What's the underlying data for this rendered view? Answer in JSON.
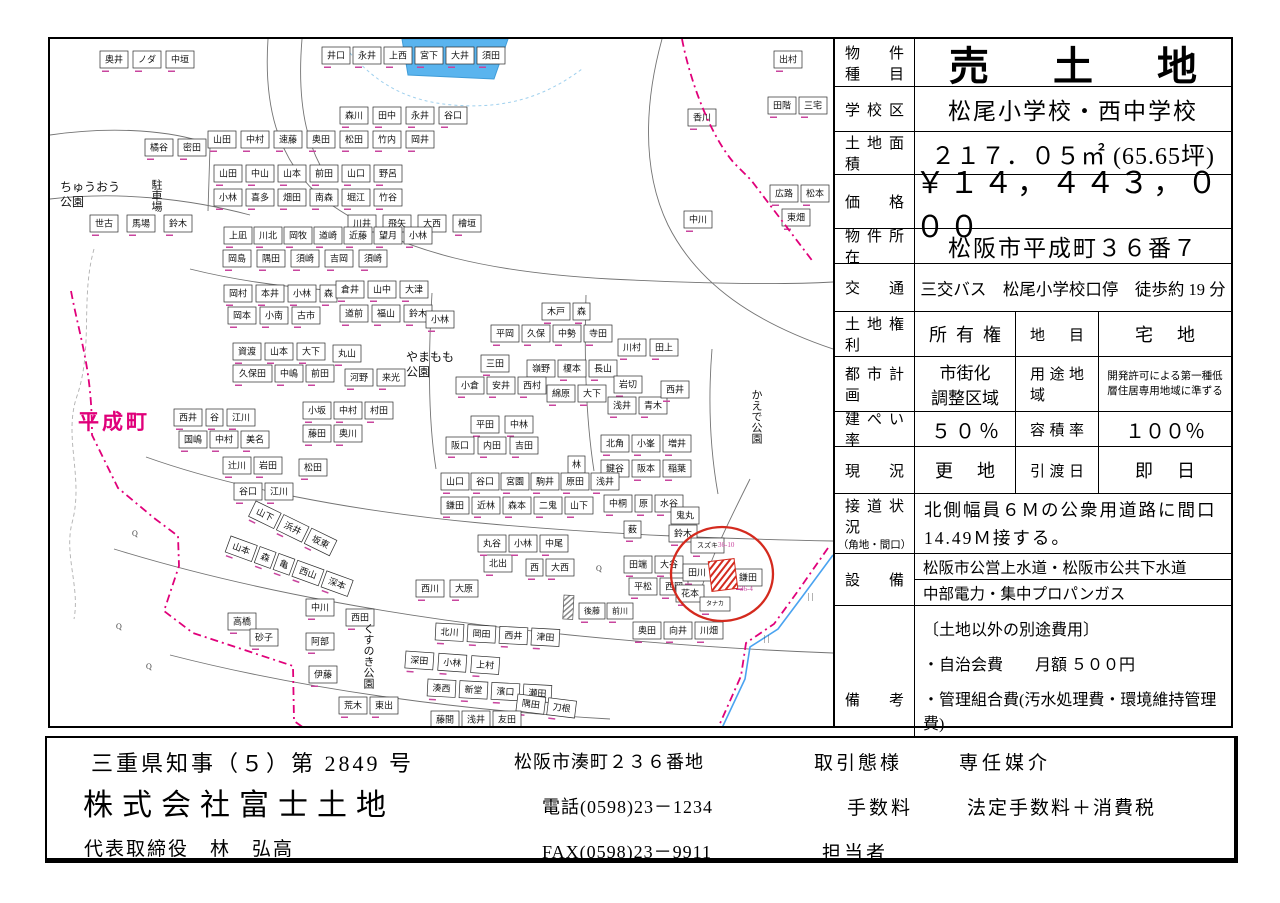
{
  "table": {
    "rows": {
      "property_type": {
        "label": "物件\n種目",
        "value": "売土地"
      },
      "school": {
        "label": "学校区",
        "value": "松尾小学校・西中学校"
      },
      "land_area": {
        "label": "土地面積",
        "value": "２１７．０５㎡ (65.65坪)"
      },
      "price": {
        "label": "価格",
        "value": "￥１４，４４３，０００"
      },
      "location": {
        "label": "物件所在",
        "value": "松阪市平成町３６番７"
      },
      "transport": {
        "label": "交通",
        "value": "三交バス　松尾小学校口停　徒歩約 19 分"
      },
      "land_rights": {
        "label": "土地権利",
        "value": "所有権",
        "label2": "地目",
        "value2": "宅地"
      },
      "city_planning": {
        "label": "都市計画",
        "value": "市街化\n調整区域",
        "label2": "用途地域",
        "value2": "開発許可による第一種低層住居専用地域に準ずる"
      },
      "coverage": {
        "label": "建ぺい率",
        "value": "５０％",
        "label2": "容積率",
        "value2": "１００％"
      },
      "status": {
        "label": "現況",
        "value": "更地",
        "label2": "引渡日",
        "value2": "即日"
      },
      "road": {
        "label": "接道状況",
        "sublabel": "（角地・間口）",
        "value": "北側幅員６Ｍの公衆用道路に間口 14.49Ｍ接する。"
      },
      "utilities": {
        "label": "設備",
        "line1": "松阪市公営上水道・松阪市公共下水道",
        "line2": "中部電力・集中プロパンガス"
      },
      "remarks": {
        "label": "備考",
        "heading": "〔土地以外の別途費用〕",
        "items": [
          "・自治会費　　月額 ５００円",
          "・管理組合費(汚水処理費・環境維持管理費)"
        ],
        "amount": "月額 ３，２００円"
      }
    }
  },
  "footer": {
    "license": "三重県知事（５）第 2849 号",
    "company": "株式会社富士土地",
    "representative": "代表取締役　林　弘高",
    "address": "松阪市湊町２３６番地",
    "phone": "電話(0598)23－1234",
    "fax": "FAX(0598)23－9911",
    "deal_type_label": "取引態様",
    "deal_type": "専任媒介",
    "fee_label": "手数料",
    "fee": "法定手数料＋消費税",
    "agent_label": "担当者"
  },
  "map": {
    "colors": {
      "boundary": "#e0007a",
      "water": "#5ab4ee",
      "stream": "#4aa3f0",
      "marker": "#d42a1e",
      "lot_number": "#c8459e"
    },
    "pond": {
      "points": "352,0 458,0 444,40 358,36",
      "outline": "M300,14 C330,48 360,62 402,66 C452,70 492,60 532,30"
    },
    "roads": [
      "M218,0 C214,60 224,122 276,162 C350,216 450,234 560,240 C660,245 730,246 783,243",
      "M252,0 C248,48 252,92 270,126",
      "M0,96 C55,88 110,90 150,102",
      "M0,160 C70,152 140,160 200,176",
      "M612,0 C596,58 590,128 618,186 C648,246 706,284 783,310",
      "M140,230 C180,240 230,248 290,252",
      "M96,418 C180,448 300,472 430,484 C560,496 680,500 783,502",
      "M64,510 C200,552 360,580 520,596 C640,608 730,612 783,614",
      "M120,616 C260,652 420,672 560,680",
      "M382,254 C378,320 378,380 386,430",
      "M536,256 C534,320 536,380 544,432",
      "M662,310 C658,360 660,410 668,455",
      "M160,108 L158,172",
      "M700,440 C680,480 660,520 648,560"
    ],
    "contour": "M44,210 C30,260 44,310 26,360 C14,400 34,440 22,484 C14,516 30,548 24,580",
    "boundaries": [
      "M632,0 C640,42 660,96 684,124 L701,141 L764,224",
      "M21,252 C30,300 42,330 42,396 L68,449 L104,479 L128,497 L129,527 L114,572 L143,594 L243,627 L244,682 L254,689",
      "M778,509 L748,552 L724,585 L696,604 L691,637 L668,689"
    ],
    "stream": "M783,516 L752,558 L728,590 L700,608 L695,640 L672,689",
    "labels": [
      {
        "name": "label-heiseicho",
        "text": "平成町",
        "x": 28,
        "y": 390,
        "size": 21,
        "magenta": true,
        "bold": true,
        "spacing": 3
      },
      {
        "name": "label-chuo-park",
        "text": "ちゅうおう\n公園",
        "x": 10,
        "y": 152,
        "size": 12
      },
      {
        "name": "label-yamamomo-park",
        "text": "やまもも\n公園",
        "x": 356,
        "y": 322,
        "size": 12
      },
      {
        "name": "label-kaede-park",
        "text": "かえで公園",
        "x": 706,
        "y": 350,
        "size": 11,
        "vertical": true
      },
      {
        "name": "label-kusunoki-park",
        "text": "くすのき公園",
        "x": 318,
        "y": 584,
        "size": 11,
        "vertical": true
      },
      {
        "name": "label-parking",
        "text": "駐車場",
        "x": 106,
        "y": 140,
        "size": 11,
        "vertical": true
      }
    ],
    "symbols": [
      {
        "t": "Q",
        "x": 82,
        "y": 497
      },
      {
        "t": "Q",
        "x": 66,
        "y": 590
      },
      {
        "t": "Q",
        "x": 96,
        "y": 630
      },
      {
        "t": "Q",
        "x": 546,
        "y": 532
      },
      {
        "t": "| |",
        "x": 758,
        "y": 560
      },
      {
        "t": "| |",
        "x": 714,
        "y": 602
      }
    ],
    "parcel_rows": [
      {
        "x": 50,
        "y": 12,
        "names": [
          "奥井",
          "ノダ",
          "中垣"
        ]
      },
      {
        "x": 95,
        "y": 100,
        "names": [
          "橘谷",
          "密田"
        ]
      },
      {
        "x": 40,
        "y": 176,
        "gap": 9,
        "names": [
          "世古",
          "馬場",
          "鈴木"
        ]
      },
      {
        "x": 272,
        "y": 8,
        "gap": 3,
        "names": [
          "井口",
          "永井",
          "上西",
          "宮下",
          "大井",
          "須田"
        ]
      },
      {
        "x": 290,
        "y": 68,
        "gap": 5,
        "names": [
          "森川",
          "田中",
          "永井",
          "谷口"
        ]
      },
      {
        "x": 638,
        "y": 70,
        "names": [
          "香川"
        ]
      },
      {
        "x": 298,
        "y": 176,
        "gap": 7,
        "names": [
          "川井",
          "飛矢",
          "大西",
          "檜垣"
        ]
      },
      {
        "x": 634,
        "y": 172,
        "names": [
          "中川"
        ]
      },
      {
        "x": 724,
        "y": 12,
        "names": [
          "出村"
        ]
      },
      {
        "x": 718,
        "y": 58,
        "gap": 3,
        "names": [
          "田階",
          "三宅"
        ]
      },
      {
        "x": 720,
        "y": 146,
        "gap": 3,
        "names": [
          "広路",
          "松本"
        ]
      },
      {
        "x": 732,
        "y": 170,
        "names": [
          "東畑"
        ]
      },
      {
        "x": 158,
        "y": 92,
        "gap": 5,
        "names": [
          "山田",
          "中村",
          "速藤",
          "奥田",
          "松田",
          "竹内",
          "岡井"
        ]
      },
      {
        "x": 164,
        "y": 126,
        "gap": 4,
        "names": [
          "山田",
          "中山",
          "山本",
          "前田",
          "山口",
          "野呂"
        ]
      },
      {
        "x": 164,
        "y": 150,
        "gap": 4,
        "names": [
          "小林",
          "喜多",
          "畑田",
          "南森",
          "堀江",
          "竹谷"
        ]
      },
      {
        "x": 174,
        "y": 188,
        "gap": 2,
        "names": [
          "上凪",
          "川北",
          "岡牧",
          "道崎",
          "近藤",
          "望月",
          "小林"
        ]
      },
      {
        "x": 173,
        "y": 211,
        "gap": 6,
        "names": [
          "岡島",
          "隅田",
          "須崎",
          "吉岡",
          "須崎"
        ]
      },
      {
        "x": 174,
        "y": 246,
        "gap": 4,
        "names": [
          "岡村",
          "本井",
          "小林",
          "森"
        ]
      },
      {
        "x": 286,
        "y": 242,
        "gap": 4,
        "names": [
          "倉井",
          "山中",
          "大津"
        ]
      },
      {
        "x": 178,
        "y": 268,
        "gap": 4,
        "names": [
          "岡本",
          "小南",
          "古市"
        ]
      },
      {
        "x": 290,
        "y": 266,
        "gap": 4,
        "names": [
          "道前",
          "福山",
          "鈴木"
        ]
      },
      {
        "x": 183,
        "y": 304,
        "gap": 4,
        "names": [
          "資渡",
          "山本",
          "大下"
        ]
      },
      {
        "x": 283,
        "y": 306,
        "names": [
          "丸山"
        ]
      },
      {
        "x": 295,
        "y": 330,
        "gap": 4,
        "names": [
          "河野",
          "来光"
        ]
      },
      {
        "x": 183,
        "y": 326,
        "gap": 3,
        "names": [
          "久保田",
          "中嶋",
          "前田"
        ]
      },
      {
        "x": 124,
        "y": 370,
        "gap": 4,
        "names": [
          "西井",
          "谷",
          "江川"
        ]
      },
      {
        "x": 253,
        "y": 363,
        "gap": 3,
        "names": [
          "小坂",
          "中村",
          "村田"
        ]
      },
      {
        "x": 129,
        "y": 392,
        "gap": 3,
        "names": [
          "国嶋",
          "中村",
          "美名"
        ]
      },
      {
        "x": 253,
        "y": 386,
        "gap": 3,
        "names": [
          "藤田",
          "奥川"
        ]
      },
      {
        "x": 173,
        "y": 418,
        "gap": 3,
        "names": [
          "辻川",
          "岩田"
        ]
      },
      {
        "x": 249,
        "y": 420,
        "names": [
          "松田"
        ]
      },
      {
        "x": 184,
        "y": 444,
        "gap": 3,
        "names": [
          "谷口",
          "江川"
        ]
      },
      {
        "x": 206,
        "y": 462,
        "rot": 26,
        "gap": 3,
        "names": [
          "山下",
          "浜井",
          "坂東"
        ]
      },
      {
        "x": 181,
        "y": 497,
        "rot": 20,
        "gap": 3,
        "names": [
          "山本",
          "森",
          "亀",
          "西山",
          "深本"
        ]
      },
      {
        "x": 376,
        "y": 272,
        "names": [
          "小林"
        ]
      },
      {
        "x": 441,
        "y": 286,
        "gap": 3,
        "names": [
          "平岡",
          "久保",
          "中勢",
          "寺田"
        ]
      },
      {
        "x": 492,
        "y": 264,
        "gap": 3,
        "names": [
          "木戸",
          "森"
        ]
      },
      {
        "x": 431,
        "y": 316,
        "names": [
          "三田"
        ]
      },
      {
        "x": 477,
        "y": 321,
        "gap": 3,
        "names": [
          "嶺野",
          "榎本",
          "長山"
        ]
      },
      {
        "x": 406,
        "y": 338,
        "gap": 3,
        "names": [
          "小倉",
          "安井",
          "西村"
        ]
      },
      {
        "x": 497,
        "y": 346,
        "gap": 3,
        "names": [
          "綿原",
          "大下"
        ]
      },
      {
        "x": 421,
        "y": 377,
        "gap": 6,
        "names": [
          "平田",
          "中林"
        ]
      },
      {
        "x": 396,
        "y": 398,
        "gap": 4,
        "names": [
          "阪口",
          "内田",
          "吉田"
        ]
      },
      {
        "x": 518,
        "y": 417,
        "names": [
          "林"
        ]
      },
      {
        "x": 551,
        "y": 396,
        "gap": 3,
        "names": [
          "北角",
          "小峯",
          "増井"
        ]
      },
      {
        "x": 551,
        "y": 421,
        "gap": 3,
        "names": [
          "鍵谷",
          "阪本",
          "稲葉"
        ]
      },
      {
        "x": 391,
        "y": 434,
        "gap": 2,
        "names": [
          "山口",
          "谷口",
          "宮園",
          "駒井",
          "原田",
          "浅井"
        ]
      },
      {
        "x": 391,
        "y": 458,
        "gap": 3,
        "names": [
          "鎌田",
          "近林",
          "森本",
          "二鬼",
          "山下"
        ]
      },
      {
        "x": 554,
        "y": 456,
        "gap": 3,
        "names": [
          "中桐",
          "原",
          "水谷"
        ]
      },
      {
        "x": 574,
        "y": 482,
        "names": [
          "薮"
        ]
      },
      {
        "x": 621,
        "y": 468,
        "names": [
          "鬼丸"
        ]
      },
      {
        "x": 568,
        "y": 300,
        "gap": 4,
        "names": [
          "川村",
          "田上"
        ]
      },
      {
        "x": 564,
        "y": 337,
        "names": [
          "岩切"
        ]
      },
      {
        "x": 558,
        "y": 358,
        "gap": 3,
        "names": [
          "浅井",
          "青木"
        ]
      },
      {
        "x": 611,
        "y": 342,
        "names": [
          "西井"
        ]
      },
      {
        "x": 574,
        "y": 517,
        "gap": 3,
        "names": [
          "田端",
          "大谷"
        ]
      },
      {
        "x": 579,
        "y": 539,
        "gap": 3,
        "names": [
          "平松",
          "西岡"
        ]
      },
      {
        "x": 434,
        "y": 516,
        "names": [
          "北出"
        ]
      },
      {
        "x": 476,
        "y": 520,
        "gap": 3,
        "names": [
          "西",
          "大西"
        ]
      },
      {
        "x": 366,
        "y": 541,
        "gap": 6,
        "names": [
          "西川",
          "大原"
        ]
      },
      {
        "x": 386,
        "y": 584,
        "rot": 3,
        "gap": 4,
        "names": [
          "北川",
          "岡田",
          "西井",
          "津田"
        ]
      },
      {
        "x": 356,
        "y": 612,
        "rot": 4,
        "gap": 5,
        "names": [
          "深田",
          "小林",
          "上村"
        ]
      },
      {
        "x": 378,
        "y": 640,
        "rot": 3,
        "gap": 4,
        "names": [
          "湊西",
          "新堂",
          "濱口",
          "瀬田"
        ]
      },
      {
        "x": 468,
        "y": 655,
        "rot": 7,
        "gap": 3,
        "names": [
          "隅田",
          "刀根"
        ]
      },
      {
        "x": 296,
        "y": 570,
        "names": [
          "西田"
        ]
      },
      {
        "x": 289,
        "y": 658,
        "gap": 3,
        "names": [
          "荒木",
          "東出"
        ]
      },
      {
        "x": 529,
        "y": 564,
        "gap": 2,
        "fs": 8,
        "names": [
          "後藤",
          "前川"
        ]
      },
      {
        "x": 583,
        "y": 583,
        "gap": 3,
        "names": [
          "奥田",
          "向井",
          "川畑"
        ]
      },
      {
        "x": 381,
        "y": 672,
        "gap": 3,
        "names": [
          "藤間",
          "浅井",
          "友田"
        ]
      },
      {
        "x": 428,
        "y": 496,
        "gap": 3,
        "names": [
          "丸谷",
          "小林",
          "中尾"
        ]
      },
      {
        "x": 178,
        "y": 574,
        "names": [
          "高橋"
        ]
      },
      {
        "x": 200,
        "y": 590,
        "names": [
          "砂子"
        ]
      },
      {
        "x": 256,
        "y": 560,
        "names": [
          "中川"
        ]
      },
      {
        "x": 256,
        "y": 594,
        "names": [
          "阿部"
        ]
      },
      {
        "x": 259,
        "y": 627,
        "names": [
          "伊藤"
        ]
      },
      {
        "x": 619,
        "y": 486,
        "names": [
          "鈴木"
        ]
      },
      {
        "x": 641,
        "y": 499,
        "fs": 7,
        "names": [
          "スズキ"
        ]
      },
      {
        "x": 633,
        "y": 525,
        "names": [
          "田川"
        ]
      },
      {
        "x": 684,
        "y": 530,
        "names": [
          "鎌田"
        ]
      },
      {
        "x": 626,
        "y": 546,
        "names": [
          "花本"
        ]
      },
      {
        "x": 650,
        "y": 558,
        "fs": 6,
        "names": [
          "タナカ"
        ]
      }
    ],
    "lot_numbers": [
      {
        "t": "36-10",
        "x": 668,
        "y": 508
      },
      {
        "t": "36-4",
        "x": 690,
        "y": 552
      }
    ],
    "gray_hatch": {
      "x": 514,
      "y": 556,
      "w": 10,
      "h": 24
    },
    "property_marker": {
      "hatch_rect": {
        "x": 660,
        "y": 521,
        "w": 26,
        "h": 30,
        "rot": -7
      },
      "ellipse": {
        "cx": 672,
        "cy": 535,
        "rx": 51,
        "ry": 47
      }
    }
  }
}
